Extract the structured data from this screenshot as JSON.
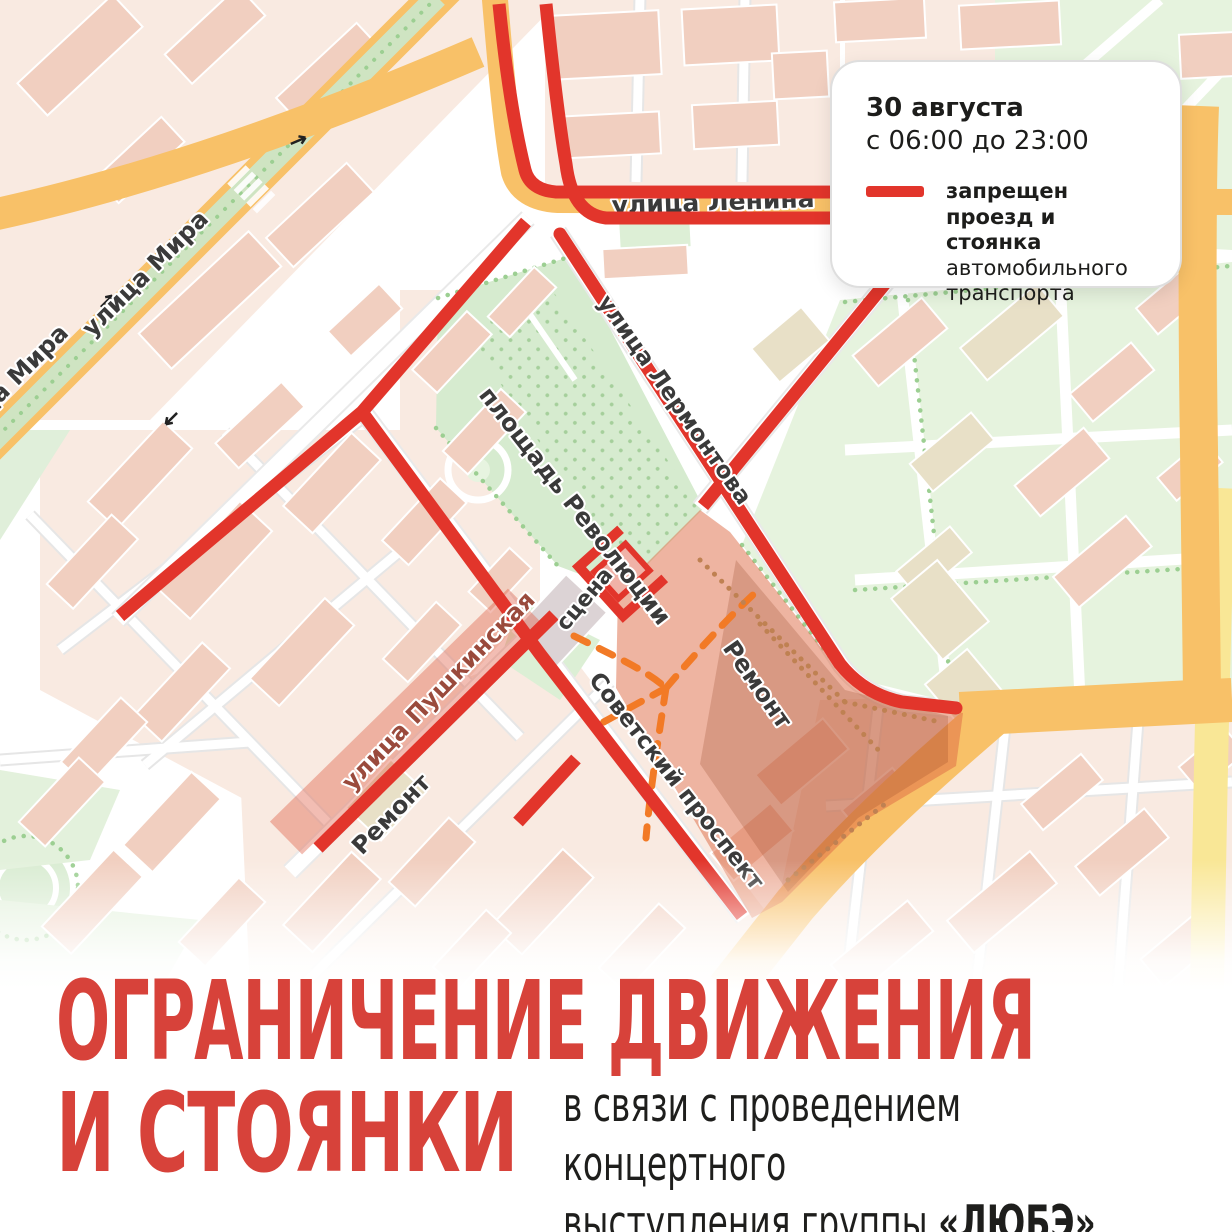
{
  "legend": {
    "date": "30 августа",
    "time": "с 06:00 до 23:00",
    "swatch_color": "#e2352b",
    "restriction_bold": "запрещен проезд и стоянка",
    "restriction_regular": "автомобильного транспорта"
  },
  "map": {
    "labels": {
      "mira": "улица Мира",
      "lenina": "улица Ленина",
      "lermontova": "улица Лермонтова",
      "revolution_square": "площадь Революции",
      "stage": "сцена",
      "remont": "Ремонт",
      "pushkinskaya": "улица Пушкинская",
      "sovetsky": "Советский проспект"
    },
    "colors": {
      "closure_red": "#e2352b",
      "major_road_orange": "#f8c168",
      "secondary_road_yellow": "#f9e796",
      "park_green": "#d6ebcf",
      "repair_zone_orange": "#dd6a43"
    }
  },
  "title": {
    "line1": "ОГРАНИЧЕНИЕ ДВИЖЕНИЯ",
    "line2": "И СТОЯНКИ",
    "subtitle_line1": "в связи с проведением концертного",
    "subtitle_line2": "выступления группы",
    "band_name": "«ЛЮБЭ»"
  }
}
